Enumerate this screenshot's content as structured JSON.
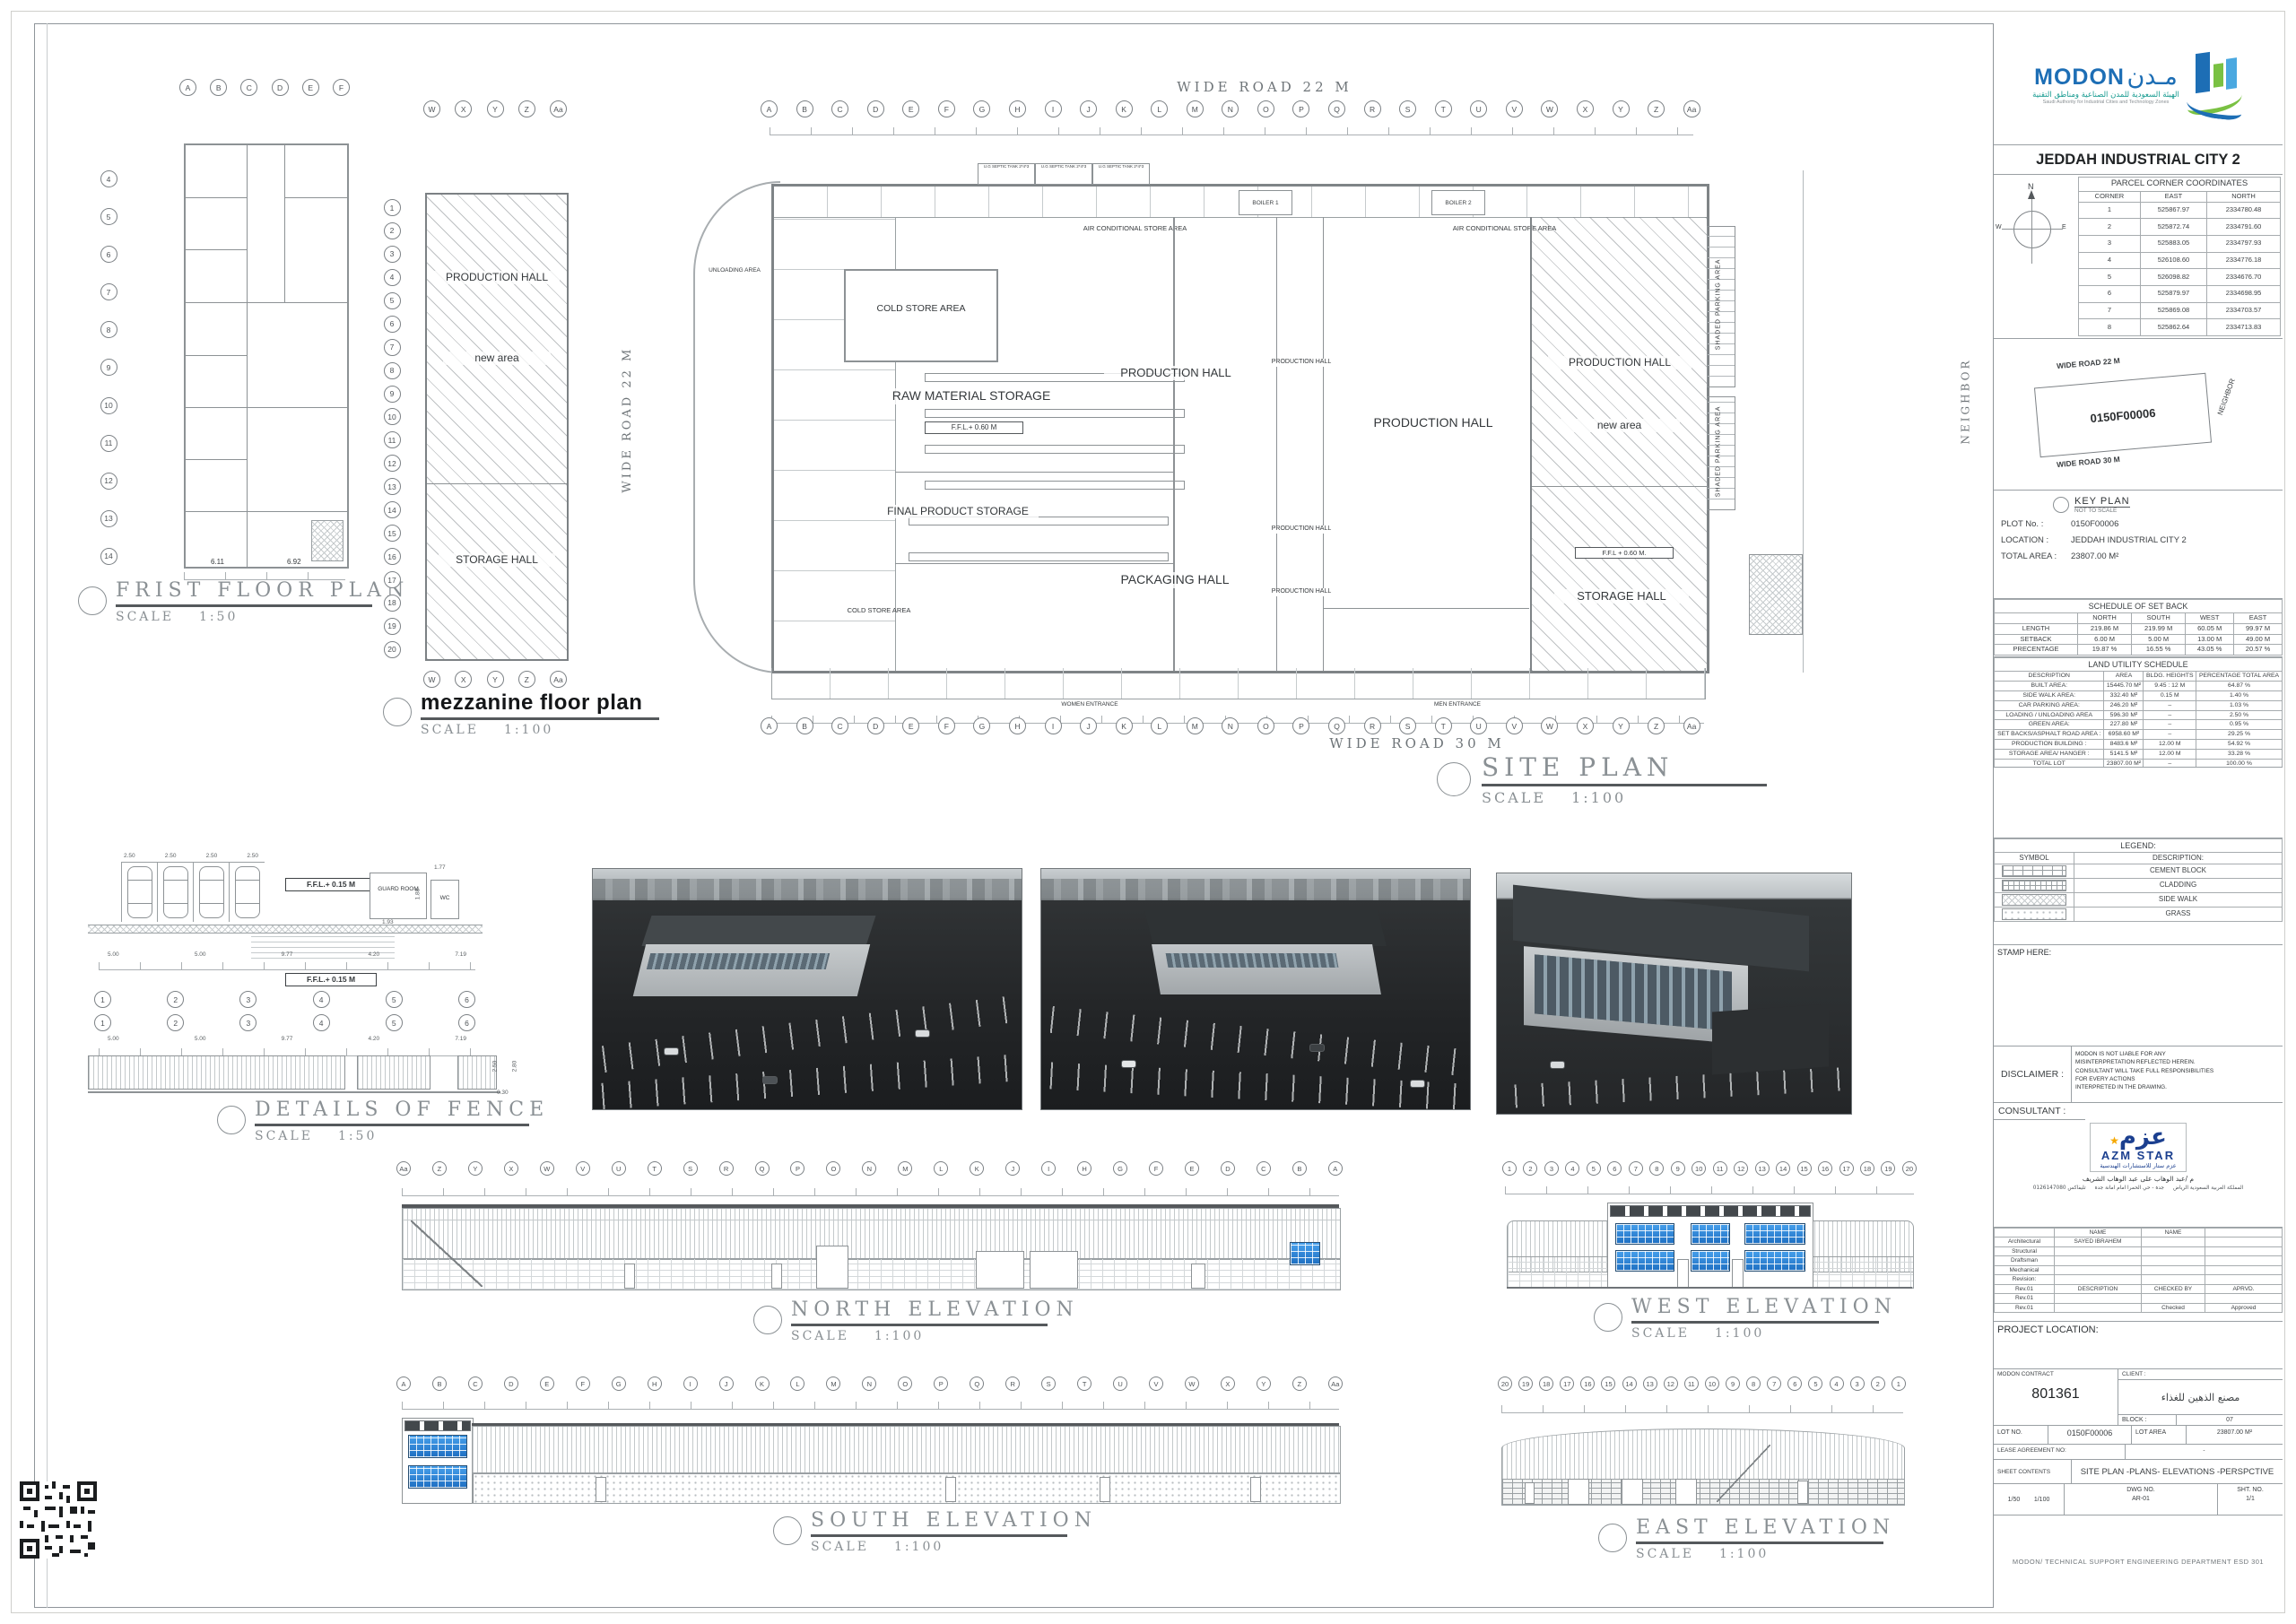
{
  "labels": {
    "scale_word": "SCALE"
  },
  "grids": {
    "letters": [
      "A",
      "B",
      "C",
      "D",
      "E",
      "F",
      "G",
      "H",
      "I",
      "J",
      "K",
      "L",
      "M",
      "N",
      "O",
      "P",
      "Q",
      "R",
      "S",
      "T",
      "U",
      "V",
      "W",
      "X",
      "Y",
      "Z",
      "Aa"
    ],
    "letters_rev": [
      "Aa",
      "Z",
      "Y",
      "X",
      "W",
      "V",
      "U",
      "T",
      "S",
      "R",
      "Q",
      "P",
      "O",
      "N",
      "M",
      "L",
      "K",
      "J",
      "I",
      "H",
      "G",
      "F",
      "E",
      "D",
      "C",
      "B",
      "A"
    ],
    "numbers20": [
      "1",
      "2",
      "3",
      "4",
      "5",
      "6",
      "7",
      "8",
      "9",
      "10",
      "11",
      "12",
      "13",
      "14",
      "15",
      "16",
      "17",
      "18",
      "19",
      "20"
    ],
    "numbers20_rev": [
      "20",
      "19",
      "18",
      "17",
      "16",
      "15",
      "14",
      "13",
      "12",
      "11",
      "10",
      "9",
      "8",
      "7",
      "6",
      "5",
      "4",
      "3",
      "2",
      "1"
    ],
    "ff_letters": [
      "A",
      "B",
      "C",
      "D",
      "E",
      "F"
    ],
    "ff_numbers": [
      "4",
      "5",
      "6",
      "7",
      "8",
      "9",
      "10",
      "11",
      "12",
      "13",
      "14"
    ],
    "mezz_letters": [
      "W",
      "X",
      "Y",
      "Z",
      "Aa"
    ],
    "fence_bubbles": [
      "1",
      "2",
      "3",
      "4",
      "5",
      "6"
    ]
  },
  "plans": {
    "first_floor": {
      "title": "FRIST  FLOOR  PLAN",
      "scale": "1:50",
      "dim_a": "6.11",
      "dim_b": "6.92"
    },
    "mezzanine": {
      "title": "mezzanine floor plan",
      "scale": "1:100",
      "production_hall": "PRODUCTION HALL",
      "new_area": "new area",
      "storage_hall": "STORAGE HALL",
      "road_left": "WIDE ROAD  22 M"
    },
    "site": {
      "title": "SITE  PLAN",
      "scale": "1:100",
      "road_top": "WIDE ROAD  22 M",
      "road_bottom": "WIDE ROAD  30 M",
      "septic": "U.G SEPTIC TANK 2*4*3",
      "boiler1": "BOILER 1",
      "boiler2": "BOILER 2",
      "ac_store": "AIR CONDITIONAL STORE AREA",
      "cold_store": "COLD STORE AREA",
      "raw_material": "RAW MATERIAL STORAGE",
      "ffl_060": "F.F.L.+ 0.60 M",
      "ffl_060b": "F.F.L + 0.60 M.",
      "final_product": "FINAL PRODUCT STORAGE",
      "production_hall": "PRODUCTION HALL",
      "packaging_hall": "PACKAGING HALL",
      "storage_hall": "STORAGE HALL",
      "new_area": "new area",
      "unloading": "UNLOADING AREA",
      "shaded_parking": "SHADED PARKING AREA",
      "neighbor": "NEIGHBOR",
      "women_entrance": "WOMEN ENTRANCE",
      "men_entrance": "MEN ENTRANCE"
    }
  },
  "fence": {
    "title": "DETAILS  OF  FENCE",
    "scale": "1:50",
    "ffl": "F.F.L.+ 0.15 M",
    "stall_dim": "2.50",
    "dims": [
      "5.00",
      "5.00",
      "9.77",
      "4.20",
      "7.19"
    ],
    "guard_room": "GUARD ROOM",
    "wc": "WC",
    "dim_193": "1.93",
    "dim_188": "1.88",
    "dim_177": "1.77",
    "h_250": "2.50",
    "h_280": "2.80",
    "h_030": "0.30"
  },
  "elevations": {
    "north": {
      "title": "NORTH  ELEVATION",
      "scale": "1:100"
    },
    "west": {
      "title": "WEST  ELEVATION",
      "scale": "1:100"
    },
    "south": {
      "title": "SOUTH  ELEVATION",
      "scale": "1:100"
    },
    "east": {
      "title": "EAST  ELEVATION",
      "scale": "1:100"
    }
  },
  "titleblock": {
    "modon": {
      "brand": "MODON",
      "brand_ar": "مـدن",
      "subtitle_ar": "الهيئة السعودية للمدن الصناعية ومناطق التقنية",
      "subtitle_en": "Saudi Authority for Industrial Cities and Technology Zones"
    },
    "project_title": "JEDDAH INDUSTRIAL CITY 2",
    "compass_n": "N",
    "compass_w": "W",
    "compass_e": "E",
    "coords": {
      "title": "PARCEL CORNER COORDINATES",
      "headers": [
        "CORNER",
        "EAST",
        "NORTH"
      ],
      "rows": [
        [
          "1",
          "525867.97",
          "2334780.48"
        ],
        [
          "2",
          "525872.74",
          "2334791.60"
        ],
        [
          "3",
          "525883.05",
          "2334797.93"
        ],
        [
          "4",
          "526108.60",
          "2334776.18"
        ],
        [
          "5",
          "526098.82",
          "2334676.70"
        ],
        [
          "6",
          "525879.97",
          "2334698.95"
        ],
        [
          "7",
          "525869.08",
          "2334703.57"
        ],
        [
          "8",
          "525862.64",
          "2334713.83"
        ]
      ]
    },
    "keyplan": {
      "road_top": "WIDE ROAD 22 M",
      "road_bottom": "WIDE ROAD 30 M",
      "neighbor": "NEIGHBOR",
      "parcel": "0150F00006",
      "title": "KEY PLAN",
      "subtitle": "NOT TO SCALE"
    },
    "plot": {
      "plot_label": "PLOT No. :",
      "plot_value": "0150F00006",
      "location_label": "LOCATION :",
      "location_value": "JEDDAH INDUSTRIAL CITY 2",
      "area_label": "TOTAL AREA :",
      "area_value": "23807.00 M²"
    },
    "setback": {
      "title": "SCHEDULE OF SET BACK",
      "col_headers": [
        "NORTH",
        "SOUTH",
        "WEST",
        "EAST"
      ],
      "length_label": "LENGTH",
      "length": [
        "219.86 M",
        "219.99 M",
        "60.05 M",
        "99.97 M"
      ],
      "setback_label": "SETBACK",
      "setback": [
        "6.00 M",
        "5.00 M",
        "13.00 M",
        "49.00 M"
      ],
      "pct_label": "PRECENTAGE",
      "pct": [
        "19.87 %",
        "16.55 %",
        "43.05 %",
        "20.57 %"
      ]
    },
    "landuse": {
      "title": "LAND UTILITY SCHEDULE",
      "headers": [
        "DESCRIPTION",
        "AREA",
        "BLDG. HEIGHTS",
        "PERCENTAGE TOTAL AREA"
      ],
      "rows": [
        [
          "BUILT AREA:",
          "15445.70 M²",
          "9.45 : 12 M",
          "64.87 %"
        ],
        [
          "SIDE WALK AREA:",
          "332.40 M²",
          "0.15 M",
          "1.40 %"
        ],
        [
          "CAR PARKING AREA:",
          "246.20 M²",
          "–",
          "1.03 %"
        ],
        [
          "LOADING / UNLOADING AREA",
          "596.30 M²",
          "–",
          "2.50 %"
        ],
        [
          "GREEN AREA:",
          "227.80 M²",
          "–",
          "0.95 %"
        ],
        [
          "SET BACKS/ASPHALT ROAD AREA :",
          "6958.60 M²",
          "–",
          "29.25 %"
        ],
        [
          "PRODUCTION BUILDING :",
          "8483.6 M²",
          "12.00 M",
          "54.92 %"
        ],
        [
          "STORAGE AREA/ HANGER :",
          "5141.5 M²",
          "12.00 M",
          "33.28 %"
        ],
        [
          "TOTAL LOT",
          "23807.00 M²",
          "–",
          "100.00 %"
        ]
      ]
    },
    "legend": {
      "title": "LEGEND:",
      "symbol_header": "SYMBOL",
      "desc_header": "DESCRIPTION:",
      "rows": [
        {
          "label": "CEMENT BLOCK"
        },
        {
          "label": "CLADDING"
        },
        {
          "label": "SIDE WALK"
        },
        {
          "label": "GRASS"
        }
      ]
    },
    "stamp_label": "STAMP HERE:",
    "disclaimer": {
      "label": "DISCLAIMER :",
      "line1": "MODON IS NOT LIABLE FOR ANY",
      "line2": "MISINTERPRETATION REFLECTED HEREIN.",
      "line3": "CONSULTANT WILL TAKE FULL RESPONSIBILITIES",
      "line4": "FOR EVERY ACTIONS",
      "line5": "INTERPRETED IN THE DRAWING."
    },
    "consultant": {
      "label": "CONSULTANT :",
      "logo_ar": "عزم",
      "logo_star": "★",
      "logo_en": "AZM STAR",
      "logo_sub_ar": "عزم ستار للاستشارات الهندسية",
      "name_ar": "م /عبد الوهاب على عبد الوهاب الشريف",
      "contact_ar_1": "المملكة العربية السعودية الرياض",
      "contact_ar_2": "جدة - حي الحمرا امام امانة جدة",
      "contact_ar_3": "تليفاكس 0126147080"
    },
    "names": {
      "name_header": "NAME",
      "architectural": "Architectural",
      "architectural_name": "SAYED IBRAHEM",
      "structural": "Structural",
      "draftsman": "Draftsman",
      "mechanical": "Mechanical",
      "revision_label": "Revision:",
      "rev": "Rev.01",
      "description": "DESCRIPTION",
      "checked_by": "CHECKED BY",
      "aprvd": "APRVD.",
      "checked": "Checked",
      "approved": "Approved"
    },
    "project_location_label": "PROJECT LOCATION:",
    "contract": {
      "label": "MODON CONTRACT",
      "value": "801361",
      "client_label": "CLIENT :",
      "client_value": "مصنع الذهين للغذاء",
      "block_label": "BLOCK :",
      "block_value": "07"
    },
    "lot": {
      "lot_label": "LOT NO.",
      "lot_value": "0150F00006",
      "area_label": "LOT AREA",
      "area_value": "23807.00 M²",
      "lease_label": "LEASE AGREEMENT NO:",
      "lease_value": "-"
    },
    "sheet_contents": {
      "label": "SHEET CONTENTS",
      "value": "SITE PLAN -PLANS-  ELEVATIONS -PERSPCTIVE"
    },
    "footer": {
      "scale_a": "1/50",
      "scale_b": "1/100",
      "dwg_label": "DWG NO.",
      "dwg_value": "AR-01",
      "sht_label": "SHT. NO.",
      "sht_value": "1/1"
    }
  },
  "footer_note": "MODON/ TECHNICAL SUPPORT ENGINEERING DEPARTMENT ESD 301"
}
